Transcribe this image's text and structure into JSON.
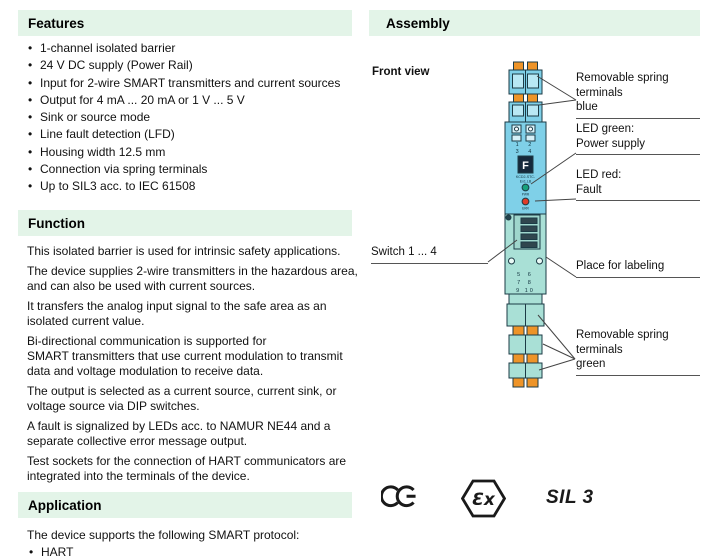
{
  "colors": {
    "header_bg": "#e3f4e8",
    "device_blue": "#7fd0e8",
    "device_blue_light": "#b8e8f4",
    "device_teal": "#a9e0d6",
    "clamp_orange": "#ee9428",
    "led_green": "#18a27d",
    "led_red": "#e03c28",
    "outline": "#1c3b46"
  },
  "sections": {
    "features": {
      "title": "Features",
      "items": [
        "1-channel isolated barrier",
        "24 V DC supply (Power Rail)",
        "Input for 2-wire SMART transmitters and current sources",
        "Output for 4 mA ... 20 mA or 1 V ... 5 V",
        "Sink or source mode",
        "Line fault detection (LFD)",
        "Housing width 12.5 mm",
        "Connection via spring terminals",
        "Up to SIL3 acc. to IEC 61508"
      ]
    },
    "function": {
      "title": "Function",
      "paragraphs": [
        [
          "This isolated barrier is used for intrinsic safety applications."
        ],
        [
          "The device supplies 2-wire transmitters in the hazardous area,",
          "and can also be used with current sources."
        ],
        [
          "It transfers the analog input signal to the safe area as an",
          "isolated current value."
        ],
        [
          "Bi-directional communication is supported for",
          "SMART transmitters that use current modulation to transmit",
          "data and voltage modulation to receive data."
        ],
        [
          "The output is selected as a current source, current sink, or",
          "voltage source via DIP switches."
        ],
        [
          "A fault is signalized by LEDs acc. to NAMUR NE44 and a",
          "separate collective error message output."
        ],
        [
          "Test sockets for the connection of HART communicators are",
          "integrated into the terminals of the device."
        ]
      ]
    },
    "application": {
      "title": "Application",
      "intro": "The device supports the following SMART protocol:",
      "items": [
        "HART"
      ]
    },
    "assembly": {
      "title": "Assembly",
      "front_view_label": "Front view",
      "callouts": {
        "terminals_blue": [
          "Removable spring terminals",
          "blue"
        ],
        "led_green": [
          "LED green:",
          "Power supply"
        ],
        "led_red": [
          "LED red:",
          "Fault"
        ],
        "switch": [
          "Switch 1 ... 4"
        ],
        "labeling": [
          "Place for labeling"
        ],
        "terminals_green": [
          "Removable spring terminals",
          "green"
        ]
      }
    },
    "certifications": {
      "ce": "CE",
      "ex": "Ɛx",
      "sil": "SIL 3"
    }
  },
  "device_markings": {
    "terminal_numbers_top": [
      "1 2",
      "3 4"
    ],
    "terminal_numbers_bottom": [
      "5 6",
      "7 8",
      "9 10"
    ],
    "logo_letter": "F",
    "model": [
      "KCD2-STC-",
      "Ex1.LB"
    ],
    "led_labels": [
      "PWR",
      "ERR"
    ]
  }
}
